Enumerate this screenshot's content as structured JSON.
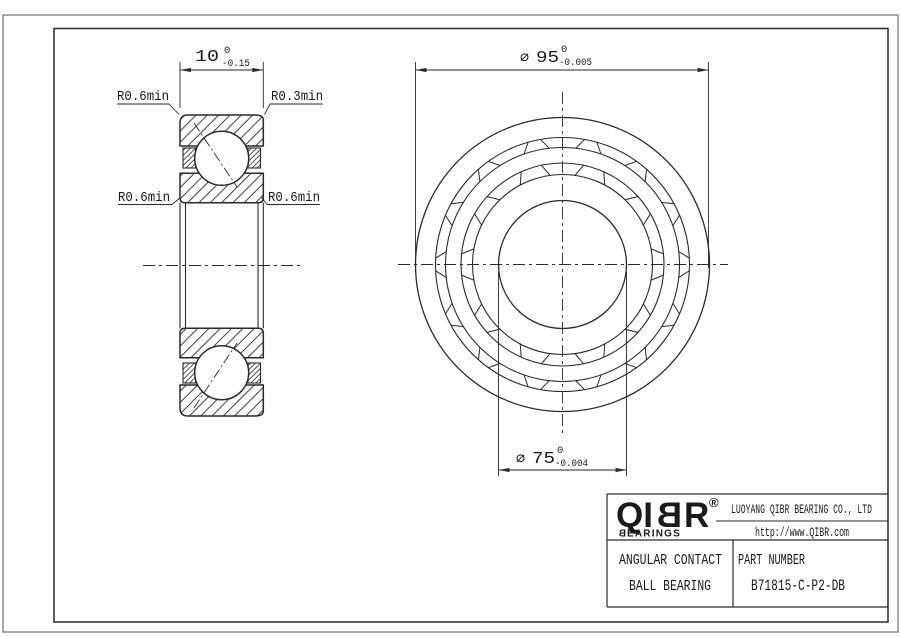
{
  "drawing": {
    "dim_width": {
      "value": "10",
      "tol_upper": "0",
      "tol_lower": "-0.15"
    },
    "dim_outer": {
      "symbol": "∅",
      "value": "95",
      "tol_upper": "0",
      "tol_lower": "-0.005"
    },
    "dim_bore": {
      "symbol": "∅",
      "value": "75",
      "tol_upper": "0",
      "tol_lower": "-0.004"
    },
    "radius_labels": {
      "top_left": "R0.6min",
      "top_right": "R0.3min",
      "mid_left": "R0.6min",
      "mid_right": "R0.6min"
    }
  },
  "title_block": {
    "logo": {
      "left": "QI",
      "mid": "B",
      "right": "R",
      "reg": "®",
      "sub_first": "B",
      "sub_rest": "EARINGS"
    },
    "company": "LUOYANG QIBR BEARING CO., LTD",
    "website": "http://www.QIBR.com",
    "product_line1": "ANGULAR CONTACT",
    "product_line2": "BALL BEARING",
    "part_label": "PART NUMBER",
    "part_number": "B71815-C-P2-DB"
  }
}
